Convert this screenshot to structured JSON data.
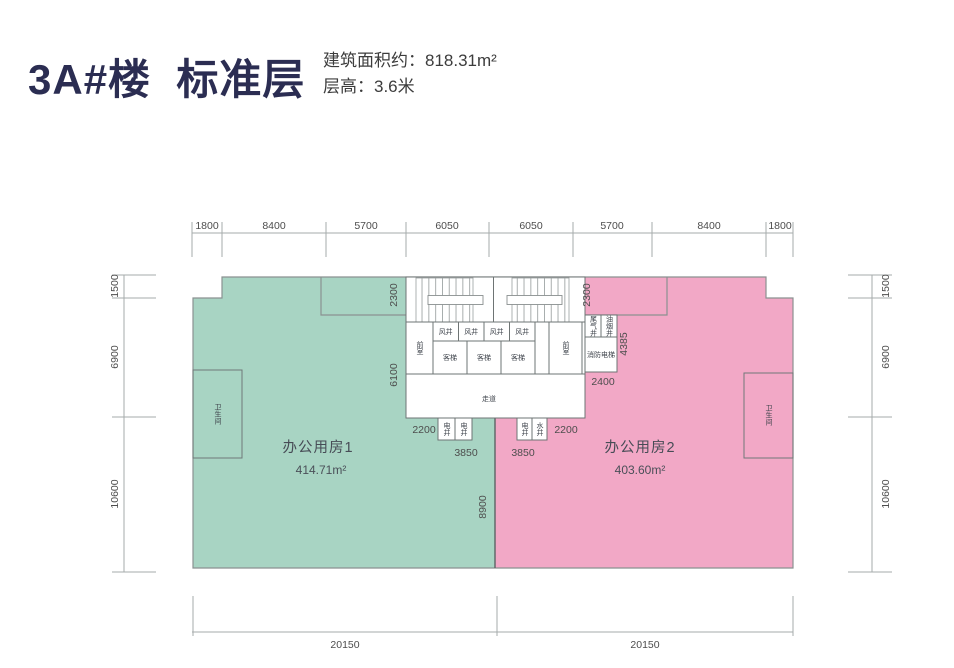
{
  "header": {
    "title": "3A#楼  标准层",
    "area_label": "建筑面积约：818.31m²",
    "floor_height_label": "层高：3.6米"
  },
  "colors": {
    "title": "#2b2d52",
    "room1_fill": "#a8d4c3",
    "room2_fill": "#f2a8c6",
    "outline": "#8b9191",
    "dim_text": "#4d4d4d"
  },
  "dims": {
    "top": [
      "1800",
      "8400",
      "5700",
      "6050",
      "6050",
      "5700",
      "8400",
      "1800"
    ],
    "left": [
      "1500",
      "6900",
      "10600"
    ],
    "right": [
      "1500",
      "6900",
      "10600"
    ],
    "bottom": [
      "20150",
      "20150"
    ],
    "core_left_width": "2300",
    "core_left_height": "6100",
    "core_right_width": "2300",
    "fire_block_height": "4385",
    "fire_block_width": "2400",
    "shaft_left_offset": "2200",
    "shaft_right_offset": "2200",
    "shaft_left_width": "3850",
    "shaft_right_width": "3850",
    "room_divider_depth": "8900"
  },
  "rooms": {
    "room1_name": "办公用房1",
    "room1_area": "414.71m²",
    "room2_name": "办公用房2",
    "room2_area": "403.60m²",
    "toilet_left": "卫生间",
    "toilet_right": "卫生间"
  },
  "core": {
    "vents": [
      "风井",
      "风井",
      "风井",
      "风井"
    ],
    "elevators": [
      "客梯",
      "客梯",
      "客梯"
    ],
    "front_left": "前室",
    "front_right": "前室",
    "corridor": "走道",
    "shafts_left": [
      "电井",
      "电井"
    ],
    "shafts_right": [
      "电井",
      "水井"
    ],
    "exhaust": "尾气井",
    "fume": "油烟井",
    "fire_elevator": "消防电梯"
  }
}
